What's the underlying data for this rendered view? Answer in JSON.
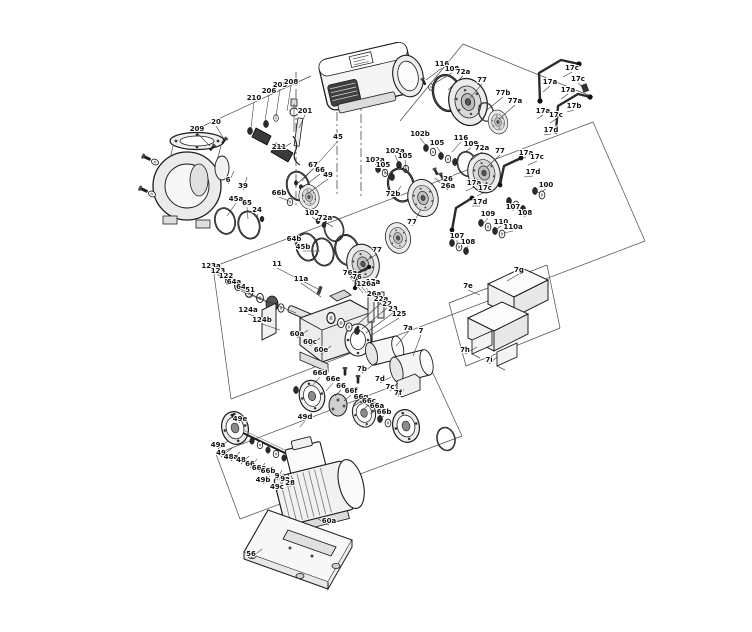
{
  "figure": {
    "type": "exploded-parts-diagram",
    "subject": "pump-assembly-with-motor",
    "background": "#ffffff",
    "line_color": "#1d1d1d",
    "label_color": "#111111"
  },
  "labels": [
    {
      "t": "209",
      "x": 197,
      "y": 131,
      "lx": 210,
      "ly": 146
    },
    {
      "t": "20",
      "x": 216,
      "y": 124,
      "lx": 224,
      "ly": 139
    },
    {
      "t": "210",
      "x": 254,
      "y": 100,
      "lx": 251,
      "ly": 128
    },
    {
      "t": "206",
      "x": 269,
      "y": 93,
      "lx": 265,
      "ly": 121
    },
    {
      "t": "205",
      "x": 280,
      "y": 87,
      "lx": 276,
      "ly": 116
    },
    {
      "t": "208",
      "x": 291,
      "y": 84,
      "lx": 287,
      "ly": 111
    },
    {
      "t": "201",
      "x": 305,
      "y": 113,
      "lx": 299,
      "ly": 128
    },
    {
      "t": "211",
      "x": 279,
      "y": 149,
      "lx": 291,
      "ly": 143
    },
    {
      "t": "6",
      "x": 228,
      "y": 182,
      "lx": 234,
      "ly": 171
    },
    {
      "t": "39",
      "x": 243,
      "y": 188,
      "lx": 247,
      "ly": 177
    },
    {
      "t": "45",
      "x": 338,
      "y": 139,
      "lx": 302,
      "ly": 181
    },
    {
      "t": "67",
      "x": 313,
      "y": 167,
      "lx": 297,
      "ly": 184
    },
    {
      "t": "66",
      "x": 320,
      "y": 172,
      "lx": 302,
      "ly": 188
    },
    {
      "t": "49",
      "x": 328,
      "y": 177,
      "lx": 307,
      "ly": 194
    },
    {
      "t": "45a",
      "x": 236,
      "y": 201,
      "lx": 227,
      "ly": 216
    },
    {
      "t": "65",
      "x": 247,
      "y": 205,
      "lx": 248,
      "ly": 219
    },
    {
      "t": "24",
      "x": 257,
      "y": 212,
      "lx": 259,
      "ly": 222
    },
    {
      "t": "66b",
      "x": 279,
      "y": 195,
      "lx": 289,
      "ly": 201
    },
    {
      "t": "102",
      "x": 312,
      "y": 215,
      "lx": 319,
      "ly": 222
    },
    {
      "t": "72a",
      "x": 325,
      "y": 220,
      "lx": 333,
      "ly": 227
    },
    {
      "t": "64b",
      "x": 294,
      "y": 241,
      "lx": 305,
      "ly": 246
    },
    {
      "t": "45b",
      "x": 303,
      "y": 249,
      "lx": 320,
      "ly": 251
    },
    {
      "t": "116",
      "x": 442,
      "y": 66,
      "lx": 426,
      "ly": 80
    },
    {
      "t": "108",
      "x": 452,
      "y": 71,
      "lx": 432,
      "ly": 85
    },
    {
      "t": "72a",
      "x": 463,
      "y": 74,
      "lx": 448,
      "ly": 90
    },
    {
      "t": "77",
      "x": 482,
      "y": 82,
      "lx": 470,
      "ly": 98
    },
    {
      "t": "77b",
      "x": 503,
      "y": 95,
      "lx": 487,
      "ly": 110
    },
    {
      "t": "77a",
      "x": 515,
      "y": 103,
      "lx": 499,
      "ly": 119
    },
    {
      "t": "17c",
      "x": 572,
      "y": 70,
      "lx": 563,
      "ly": 77
    },
    {
      "t": "17a",
      "x": 550,
      "y": 84,
      "lx": 543,
      "ly": 92
    },
    {
      "t": "17c",
      "x": 578,
      "y": 81,
      "lx": 585,
      "ly": 89
    },
    {
      "t": "17a",
      "x": 568,
      "y": 92,
      "lx": 561,
      "ly": 99
    },
    {
      "t": "17b",
      "x": 574,
      "y": 108,
      "lx": 567,
      "ly": 112
    },
    {
      "t": "17a",
      "x": 543,
      "y": 113,
      "lx": 537,
      "ly": 119
    },
    {
      "t": "17c",
      "x": 556,
      "y": 117,
      "lx": 550,
      "ly": 123
    },
    {
      "t": "17d",
      "x": 551,
      "y": 132,
      "lx": 544,
      "ly": 135
    },
    {
      "t": "102b",
      "x": 420,
      "y": 136,
      "lx": 428,
      "ly": 148
    },
    {
      "t": "105",
      "x": 437,
      "y": 145,
      "lx": 441,
      "ly": 153
    },
    {
      "t": "116",
      "x": 461,
      "y": 140,
      "lx": 452,
      "ly": 152
    },
    {
      "t": "109",
      "x": 471,
      "y": 146,
      "lx": 458,
      "ly": 156
    },
    {
      "t": "72a",
      "x": 482,
      "y": 150,
      "lx": 470,
      "ly": 161
    },
    {
      "t": "77",
      "x": 500,
      "y": 153,
      "lx": 487,
      "ly": 167
    },
    {
      "t": "17a",
      "x": 526,
      "y": 155,
      "lx": 517,
      "ly": 161
    },
    {
      "t": "17c",
      "x": 537,
      "y": 159,
      "lx": 528,
      "ly": 165
    },
    {
      "t": "17d",
      "x": 533,
      "y": 174,
      "lx": 524,
      "ly": 177
    },
    {
      "t": "26",
      "x": 448,
      "y": 181,
      "lx": 437,
      "ly": 172
    },
    {
      "t": "26a",
      "x": 448,
      "y": 188,
      "lx": 435,
      "ly": 178
    },
    {
      "t": "102a",
      "x": 375,
      "y": 162,
      "lx": 381,
      "ly": 171
    },
    {
      "t": "105",
      "x": 383,
      "y": 167,
      "lx": 388,
      "ly": 175
    },
    {
      "t": "102a",
      "x": 395,
      "y": 153,
      "lx": 399,
      "ly": 164
    },
    {
      "t": "105",
      "x": 405,
      "y": 158,
      "lx": 406,
      "ly": 168
    },
    {
      "t": "72b",
      "x": 393,
      "y": 196,
      "lx": 401,
      "ly": 186
    },
    {
      "t": "77",
      "x": 412,
      "y": 224,
      "lx": 421,
      "ly": 209
    },
    {
      "t": "17a",
      "x": 474,
      "y": 185,
      "lx": 466,
      "ly": 191
    },
    {
      "t": "17c",
      "x": 485,
      "y": 190,
      "lx": 477,
      "ly": 196
    },
    {
      "t": "17d",
      "x": 480,
      "y": 204,
      "lx": 472,
      "ly": 206
    },
    {
      "t": "109",
      "x": 488,
      "y": 216,
      "lx": 483,
      "ly": 224
    },
    {
      "t": "110",
      "x": 501,
      "y": 224,
      "lx": 495,
      "ly": 230
    },
    {
      "t": "110a",
      "x": 513,
      "y": 229,
      "lx": 504,
      "ly": 233
    },
    {
      "t": "107",
      "x": 457,
      "y": 238,
      "lx": 457,
      "ly": 245
    },
    {
      "t": "108",
      "x": 468,
      "y": 244,
      "lx": 466,
      "ly": 250
    },
    {
      "t": "107",
      "x": 513,
      "y": 209,
      "lx": 512,
      "ly": 203
    },
    {
      "t": "108",
      "x": 525,
      "y": 215,
      "lx": 521,
      "ly": 208
    },
    {
      "t": "100",
      "x": 546,
      "y": 187,
      "lx": 538,
      "ly": 193
    },
    {
      "t": "77",
      "x": 377,
      "y": 252,
      "lx": 366,
      "ly": 261
    },
    {
      "t": "17a",
      "x": 373,
      "y": 284,
      "lx": 364,
      "ly": 286
    },
    {
      "t": "123a",
      "x": 211,
      "y": 268,
      "lx": 227,
      "ly": 280
    },
    {
      "t": "123",
      "x": 218,
      "y": 273,
      "lx": 237,
      "ly": 286
    },
    {
      "t": "122",
      "x": 226,
      "y": 278,
      "lx": 248,
      "ly": 292
    },
    {
      "t": "64a",
      "x": 234,
      "y": 284,
      "lx": 259,
      "ly": 298
    },
    {
      "t": "64",
      "x": 241,
      "y": 289,
      "lx": 269,
      "ly": 303
    },
    {
      "t": "51",
      "x": 250,
      "y": 292,
      "lx": 296,
      "ly": 313
    },
    {
      "t": "11",
      "x": 277,
      "y": 266,
      "lx": 318,
      "ly": 289
    },
    {
      "t": "11a",
      "x": 301,
      "y": 281,
      "lx": 321,
      "ly": 297
    },
    {
      "t": "76a",
      "x": 350,
      "y": 275,
      "lx": 363,
      "ly": 293
    },
    {
      "t": "76",
      "x": 357,
      "y": 279,
      "lx": 369,
      "ly": 296
    },
    {
      "t": "126a",
      "x": 366,
      "y": 286,
      "lx": 376,
      "ly": 300
    },
    {
      "t": "26a",
      "x": 374,
      "y": 296,
      "lx": 383,
      "ly": 306
    },
    {
      "t": "22a",
      "x": 381,
      "y": 301,
      "lx": 357,
      "ly": 325
    },
    {
      "t": "22",
      "x": 387,
      "y": 306,
      "lx": 362,
      "ly": 329
    },
    {
      "t": "23",
      "x": 393,
      "y": 311,
      "lx": 366,
      "ly": 333
    },
    {
      "t": "125",
      "x": 399,
      "y": 316,
      "lx": 370,
      "ly": 336
    },
    {
      "t": "124a",
      "x": 248,
      "y": 312,
      "lx": 266,
      "ly": 320
    },
    {
      "t": "124b",
      "x": 262,
      "y": 322,
      "lx": 280,
      "ly": 330
    },
    {
      "t": "60a",
      "x": 297,
      "y": 336,
      "lx": 308,
      "ly": 330
    },
    {
      "t": "60c",
      "x": 310,
      "y": 344,
      "lx": 320,
      "ly": 338
    },
    {
      "t": "60e",
      "x": 321,
      "y": 352,
      "lx": 331,
      "ly": 346
    },
    {
      "t": "7a",
      "x": 408,
      "y": 330,
      "lx": 396,
      "ly": 346
    },
    {
      "t": "7",
      "x": 421,
      "y": 333,
      "lx": 413,
      "ly": 356
    },
    {
      "t": "7b",
      "x": 362,
      "y": 371,
      "lx": 377,
      "ly": 362
    },
    {
      "t": "7d",
      "x": 380,
      "y": 381,
      "lx": 391,
      "ly": 377
    },
    {
      "t": "7c",
      "x": 390,
      "y": 389,
      "lx": 398,
      "ly": 383
    },
    {
      "t": "7f",
      "x": 398,
      "y": 395,
      "lx": 404,
      "ly": 389
    },
    {
      "t": "7g",
      "x": 519,
      "y": 272,
      "lx": 507,
      "ly": 281
    },
    {
      "t": "7e",
      "x": 468,
      "y": 288,
      "lx": 480,
      "ly": 295
    },
    {
      "t": "7h",
      "x": 465,
      "y": 352,
      "lx": 477,
      "ly": 347
    },
    {
      "t": "7i",
      "x": 489,
      "y": 362,
      "lx": 497,
      "ly": 357
    },
    {
      "t": "66d",
      "x": 320,
      "y": 375,
      "lx": 313,
      "ly": 385
    },
    {
      "t": "66e",
      "x": 333,
      "y": 381,
      "lx": 326,
      "ly": 391
    },
    {
      "t": "66",
      "x": 341,
      "y": 388,
      "lx": 335,
      "ly": 396
    },
    {
      "t": "66f",
      "x": 351,
      "y": 393,
      "lx": 344,
      "ly": 401
    },
    {
      "t": "66g",
      "x": 361,
      "y": 399,
      "lx": 354,
      "ly": 406
    },
    {
      "t": "66c",
      "x": 369,
      "y": 403,
      "lx": 362,
      "ly": 410
    },
    {
      "t": "66a",
      "x": 377,
      "y": 408,
      "lx": 370,
      "ly": 414
    },
    {
      "t": "66b",
      "x": 384,
      "y": 414,
      "lx": 377,
      "ly": 419
    },
    {
      "t": "49e",
      "x": 240,
      "y": 421,
      "lx": 233,
      "ly": 414
    },
    {
      "t": "49d",
      "x": 305,
      "y": 419,
      "lx": 300,
      "ly": 427
    },
    {
      "t": "49a",
      "x": 218,
      "y": 447,
      "lx": 228,
      "ly": 441
    },
    {
      "t": "49",
      "x": 221,
      "y": 455,
      "lx": 232,
      "ly": 448
    },
    {
      "t": "48a",
      "x": 231,
      "y": 459,
      "lx": 240,
      "ly": 452
    },
    {
      "t": "48",
      "x": 241,
      "y": 462,
      "lx": 249,
      "ly": 456
    },
    {
      "t": "66",
      "x": 250,
      "y": 466,
      "lx": 257,
      "ly": 459
    },
    {
      "t": "66a",
      "x": 259,
      "y": 470,
      "lx": 265,
      "ly": 463
    },
    {
      "t": "66b",
      "x": 268,
      "y": 473,
      "lx": 273,
      "ly": 466
    },
    {
      "t": "9",
      "x": 277,
      "y": 478,
      "lx": 282,
      "ly": 470
    },
    {
      "t": "9a",
      "x": 285,
      "y": 481,
      "lx": 289,
      "ly": 474
    },
    {
      "t": "28",
      "x": 290,
      "y": 485,
      "lx": 293,
      "ly": 478
    },
    {
      "t": "49b",
      "x": 263,
      "y": 482,
      "lx": 270,
      "ly": 476
    },
    {
      "t": "49c",
      "x": 277,
      "y": 489,
      "lx": 283,
      "ly": 482
    },
    {
      "t": "60a",
      "x": 329,
      "y": 523,
      "lx": 318,
      "ly": 519
    },
    {
      "t": "56",
      "x": 251,
      "y": 556,
      "lx": 262,
      "ly": 549
    }
  ]
}
